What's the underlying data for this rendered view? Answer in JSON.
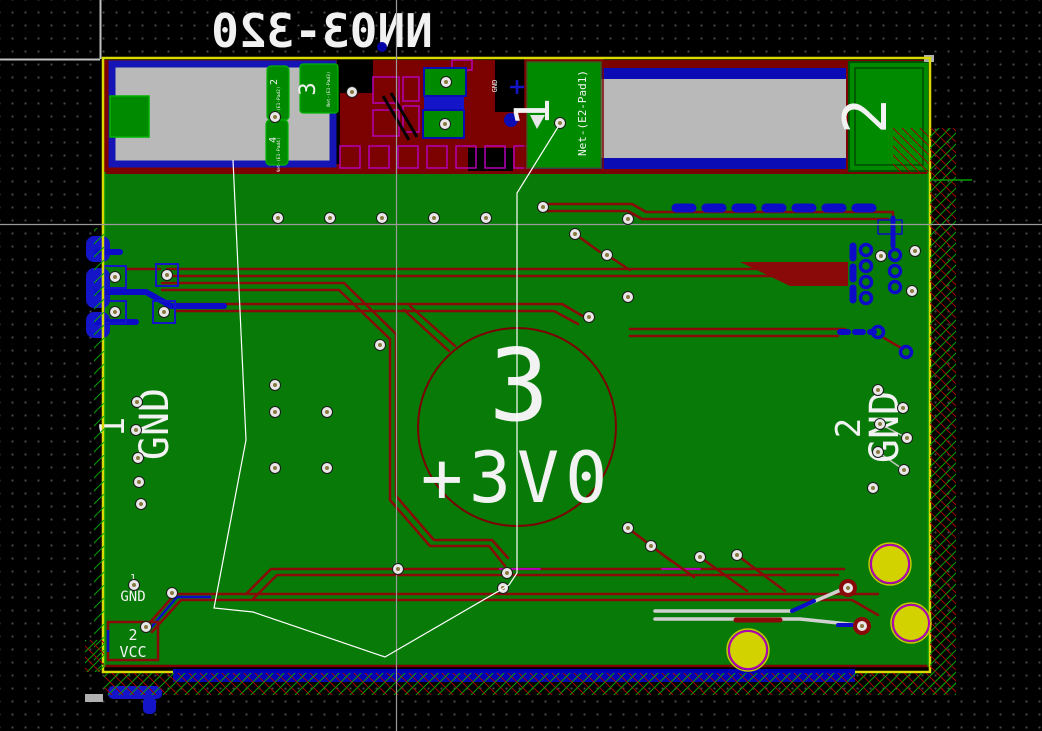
{
  "texts": {
    "sheet_title_mirrored": "NN03-320",
    "center": {
      "pad_number": "3",
      "net": "+3V0"
    },
    "left_zone": {
      "pad_number": "1",
      "net": "GND"
    },
    "right_zone": {
      "pad_number": "2",
      "net": "GND"
    },
    "antenna_pad": {
      "number": "1",
      "net": "Net-(E2-Pad1)"
    },
    "edge_pad_2": {
      "number": "2"
    },
    "module_pad_2": {
      "number": "2",
      "net": "Net-(E1-Pad2)"
    },
    "module_pad_3": {
      "number": "3",
      "net": "Net-(E1-Pad3)"
    },
    "module_pad_4": {
      "number": "4",
      "net": "Net-(E1-Pad4)"
    },
    "gnd_via_label": "GND",
    "bottom": {
      "pin1": "1",
      "pin1_net": "GND",
      "pin2": "2",
      "pin2_net": "VCC"
    }
  },
  "colors": {
    "board_pour_green": "#077a07",
    "pad_green": "#008a00",
    "copper_red": "#8a0a0a",
    "zone_dark_red": "#7c0202",
    "copper_blue": "#0c0cc8",
    "board_edge_yellow": "#d9d900",
    "module_gray": "#b9b9b9",
    "magenta_outline": "#b400b4",
    "title_blue": "#0000a6",
    "mount_hole_yellow": "#d2d200",
    "crosshair_gray": "#9a9a9a"
  },
  "vias": {
    "standard": [
      [
        352,
        92
      ],
      [
        446,
        82
      ],
      [
        445,
        124
      ],
      [
        560,
        123
      ],
      [
        275,
        117
      ],
      [
        278,
        218
      ],
      [
        330,
        218
      ],
      [
        382,
        218
      ],
      [
        434,
        218
      ],
      [
        486,
        218
      ],
      [
        543,
        207
      ],
      [
        628,
        219
      ],
      [
        575,
        234
      ],
      [
        607,
        255
      ],
      [
        628,
        297
      ],
      [
        589,
        317
      ],
      [
        881,
        256
      ],
      [
        915,
        251
      ],
      [
        912,
        291
      ],
      [
        137,
        402
      ],
      [
        136,
        430
      ],
      [
        138,
        458
      ],
      [
        139,
        482
      ],
      [
        141,
        504
      ],
      [
        275,
        385
      ],
      [
        275,
        412
      ],
      [
        275,
        468
      ],
      [
        327,
        412
      ],
      [
        327,
        468
      ],
      [
        380,
        345
      ],
      [
        115,
        277
      ],
      [
        167,
        275
      ],
      [
        115,
        312
      ],
      [
        164,
        312
      ],
      [
        878,
        390
      ],
      [
        903,
        408
      ],
      [
        880,
        424
      ],
      [
        907,
        438
      ],
      [
        878,
        452
      ],
      [
        904,
        470
      ],
      [
        873,
        488
      ],
      [
        134,
        585
      ],
      [
        172,
        593
      ],
      [
        146,
        627
      ],
      [
        398,
        569
      ],
      [
        507,
        573
      ],
      [
        503,
        588
      ],
      [
        628,
        528
      ],
      [
        651,
        546
      ],
      [
        700,
        557
      ],
      [
        737,
        555
      ]
    ],
    "red_ring": [
      [
        848,
        588
      ],
      [
        862,
        626
      ]
    ],
    "blue_pads": [
      [
        866,
        250
      ],
      [
        866,
        266
      ],
      [
        866,
        282
      ],
      [
        866,
        298
      ],
      [
        895,
        255
      ],
      [
        895,
        271
      ],
      [
        895,
        287
      ],
      [
        878,
        332
      ],
      [
        906,
        352
      ]
    ],
    "mount_holes": [
      [
        890,
        564,
        19
      ],
      [
        911,
        623,
        18
      ],
      [
        748,
        650,
        19
      ]
    ]
  }
}
